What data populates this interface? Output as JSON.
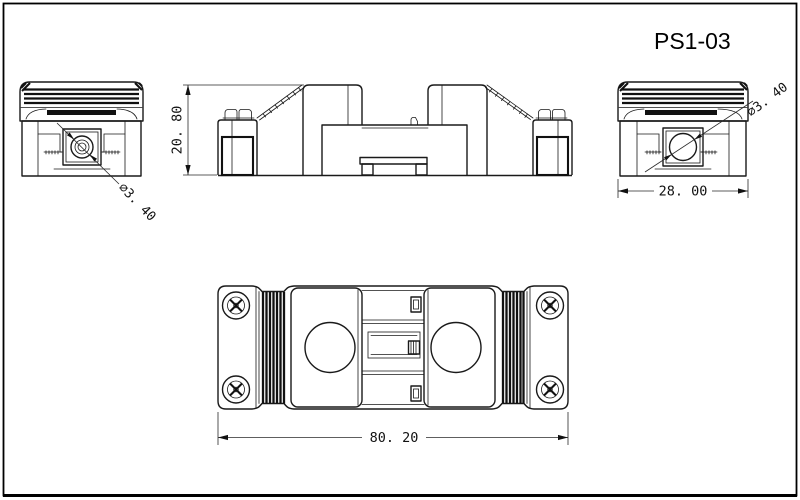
{
  "page": {
    "background_color": "#ffffff",
    "line_color": "#1a1a1a"
  },
  "title": {
    "part_number": "PS1-03"
  },
  "dimensions": {
    "height": "20. 80",
    "end_width": "28. 00",
    "overall_length": "80. 20",
    "hole_left": "∅3. 40",
    "hole_right": "∅3. 40"
  }
}
